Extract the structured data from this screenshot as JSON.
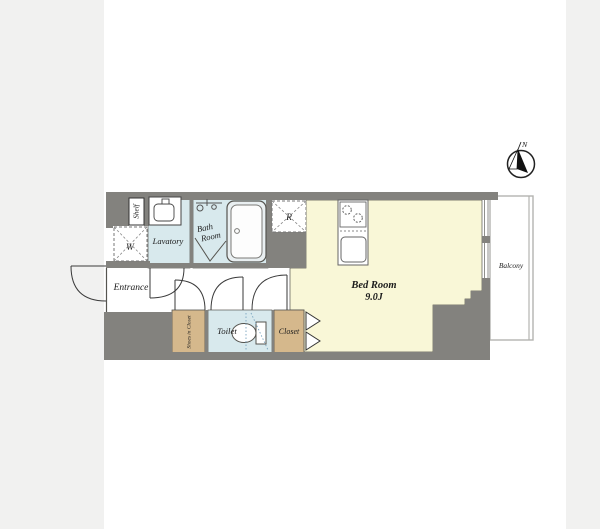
{
  "page": {
    "background": "#f1f1f0",
    "plan_background": "#ffffff"
  },
  "palette": {
    "wall_gray": "#83827e",
    "bedroom_yellow": "#f9f7d7",
    "wet_room_blue": "#d8e9ed",
    "closet_tan": "#d5b88c",
    "balcony_line_gray": "#b3b3b0"
  },
  "rooms": {
    "bedroom": {
      "name": "Bed Room",
      "area": "9.0J"
    },
    "bath": {
      "name_line1": "Bath",
      "name_line2": "Room"
    },
    "lavatory": {
      "name": "Lavatory"
    },
    "toilet": {
      "name": "Toilet"
    },
    "closet": {
      "name": "Closet"
    },
    "shoes_closet": {
      "name": "Shoes in Closet"
    },
    "shelf": {
      "name": "Shelf"
    },
    "entrance": {
      "name": "Entrance"
    },
    "balcony": {
      "name": "Balcony"
    }
  },
  "appliances": {
    "washing_machine": "W",
    "refrigerator": "R"
  },
  "compass": {
    "north": "N"
  }
}
